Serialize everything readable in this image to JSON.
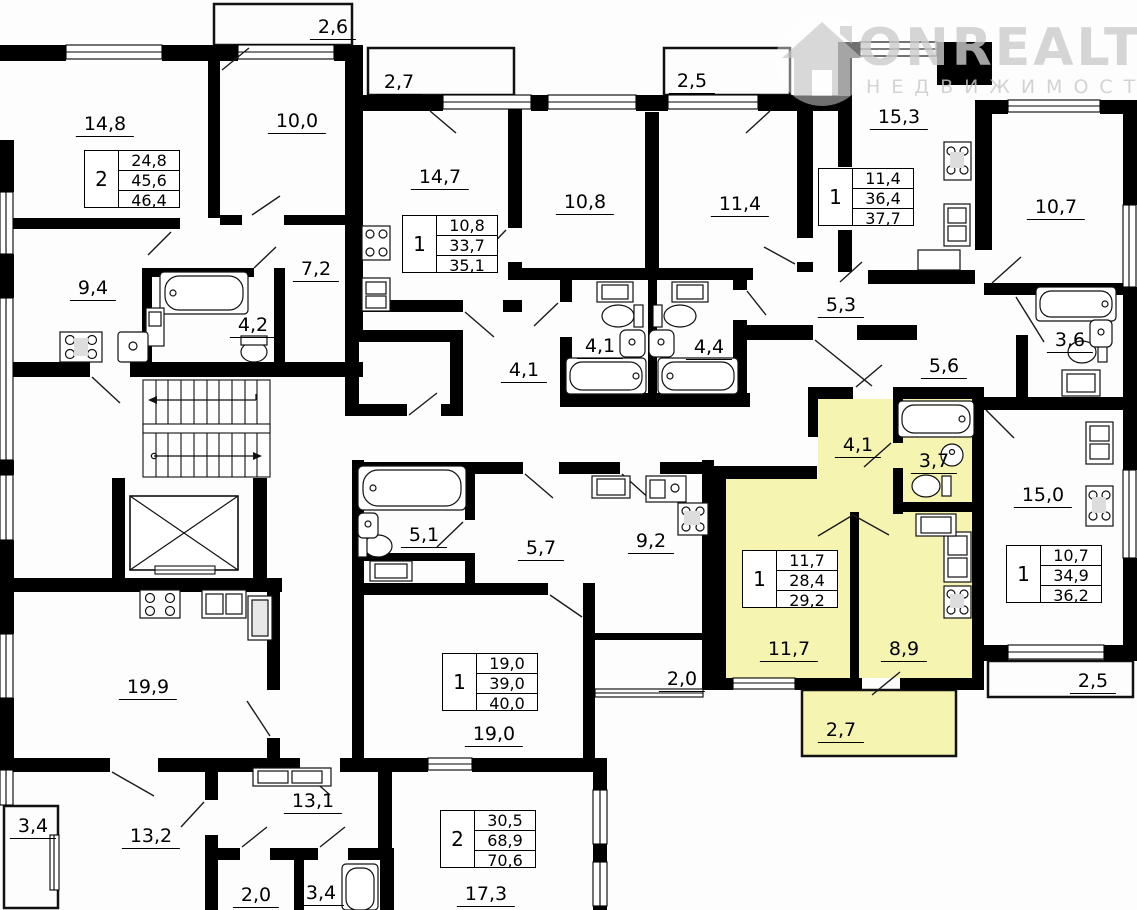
{
  "watermark": {
    "brand": "ONREALT",
    "subtitle": "НЕДВИЖИМОСТЬ"
  },
  "colors": {
    "highlight": "#f5f4b0",
    "wall": "#000000",
    "watermark": "#cccccc"
  },
  "labels": [
    {
      "id": "balcony-2-6",
      "text": "2,6",
      "x": 333,
      "y": 30
    },
    {
      "id": "balcony-2-7-top",
      "text": "2,7",
      "x": 399,
      "y": 85
    },
    {
      "id": "balcony-2-5-top",
      "text": "2,5",
      "x": 692,
      "y": 84
    },
    {
      "id": "room-14-8",
      "text": "14,8",
      "x": 105,
      "y": 127
    },
    {
      "id": "room-10-0",
      "text": "10,0",
      "x": 297,
      "y": 124
    },
    {
      "id": "room-14-7",
      "text": "14,7",
      "x": 440,
      "y": 180
    },
    {
      "id": "room-10-8",
      "text": "10,8",
      "x": 585,
      "y": 205
    },
    {
      "id": "room-11-4",
      "text": "11,4",
      "x": 740,
      "y": 207
    },
    {
      "id": "room-15-3",
      "text": "15,3",
      "x": 899,
      "y": 120
    },
    {
      "id": "room-10-7",
      "text": "10,7",
      "x": 1056,
      "y": 210
    },
    {
      "id": "room-9-4",
      "text": "9,4",
      "x": 93,
      "y": 291
    },
    {
      "id": "bath-4-2",
      "text": "4,2",
      "x": 253,
      "y": 328
    },
    {
      "id": "hall-7-2",
      "text": "7,2",
      "x": 316,
      "y": 272
    },
    {
      "id": "hall-4-1-mid",
      "text": "4,1",
      "x": 524,
      "y": 373
    },
    {
      "id": "bath-4-1",
      "text": "4,1",
      "x": 600,
      "y": 349
    },
    {
      "id": "bath-4-4",
      "text": "4,4",
      "x": 709,
      "y": 350
    },
    {
      "id": "hall-5-3",
      "text": "5,3",
      "x": 841,
      "y": 308
    },
    {
      "id": "hall-5-6",
      "text": "5,6",
      "x": 944,
      "y": 369
    },
    {
      "id": "bath-3-6",
      "text": "3,6",
      "x": 1070,
      "y": 343
    },
    {
      "id": "hall-4-1-highlight",
      "text": "4,1",
      "x": 858,
      "y": 448
    },
    {
      "id": "bath-3-7",
      "text": "3,7",
      "x": 934,
      "y": 464
    },
    {
      "id": "room-15-0",
      "text": "15,0",
      "x": 1043,
      "y": 498
    },
    {
      "id": "bath-5-1",
      "text": "5,1",
      "x": 424,
      "y": 538
    },
    {
      "id": "hall-5-7",
      "text": "5,7",
      "x": 541,
      "y": 551
    },
    {
      "id": "kitchen-9-2",
      "text": "9,2",
      "x": 651,
      "y": 544
    },
    {
      "id": "room-11-7",
      "text": "11,7",
      "x": 789,
      "y": 652
    },
    {
      "id": "kitchen-8-9",
      "text": "8,9",
      "x": 904,
      "y": 652
    },
    {
      "id": "room-19-9",
      "text": "19,9",
      "x": 148,
      "y": 690
    },
    {
      "id": "loggia-2-0",
      "text": "2,0",
      "x": 682,
      "y": 682
    },
    {
      "id": "balcony-2-5-right",
      "text": "2,5",
      "x": 1093,
      "y": 684
    },
    {
      "id": "balcony-2-7-highlight",
      "text": "2,7",
      "x": 841,
      "y": 733
    },
    {
      "id": "room-13-2",
      "text": "13,2",
      "x": 151,
      "y": 839
    },
    {
      "id": "loggia-3-4-left",
      "text": "3,4",
      "x": 33,
      "y": 829
    },
    {
      "id": "hall-13-1",
      "text": "13,1",
      "x": 313,
      "y": 804
    },
    {
      "id": "room-19-0",
      "text": "19,0",
      "x": 494,
      "y": 737
    },
    {
      "id": "room-17-3",
      "text": "17,3",
      "x": 486,
      "y": 897
    },
    {
      "id": "wc-2-0",
      "text": "2,0",
      "x": 256,
      "y": 898
    },
    {
      "id": "bath-3-4",
      "text": "3,4",
      "x": 321,
      "y": 896
    }
  ],
  "tables": [
    {
      "id": "apt-2-room-topleft",
      "rooms": "2",
      "living": "24,8",
      "area": "45,6",
      "total": "46,4",
      "x": 84,
      "y": 150
    },
    {
      "id": "apt-1-room-topmid",
      "rooms": "1",
      "living": "10,8",
      "area": "33,7",
      "total": "35,1",
      "x": 402,
      "y": 215
    },
    {
      "id": "apt-1-room-topright",
      "rooms": "1",
      "living": "11,4",
      "area": "36,4",
      "total": "37,7",
      "x": 818,
      "y": 168
    },
    {
      "id": "apt-1-room-right",
      "rooms": "1",
      "living": "10,7",
      "area": "34,9",
      "total": "36,2",
      "x": 1006,
      "y": 545
    },
    {
      "id": "apt-1-room-studio",
      "rooms": "1",
      "living": "19,0",
      "area": "39,0",
      "total": "40,0",
      "x": 442,
      "y": 653
    },
    {
      "id": "apt-1-room-highlight",
      "rooms": "1",
      "living": "11,7",
      "area": "28,4",
      "total": "29,2",
      "x": 742,
      "y": 550
    },
    {
      "id": "apt-2-room-bottom",
      "rooms": "2",
      "living": "30,5",
      "area": "68,9",
      "total": "70,6",
      "x": 440,
      "y": 810
    }
  ]
}
